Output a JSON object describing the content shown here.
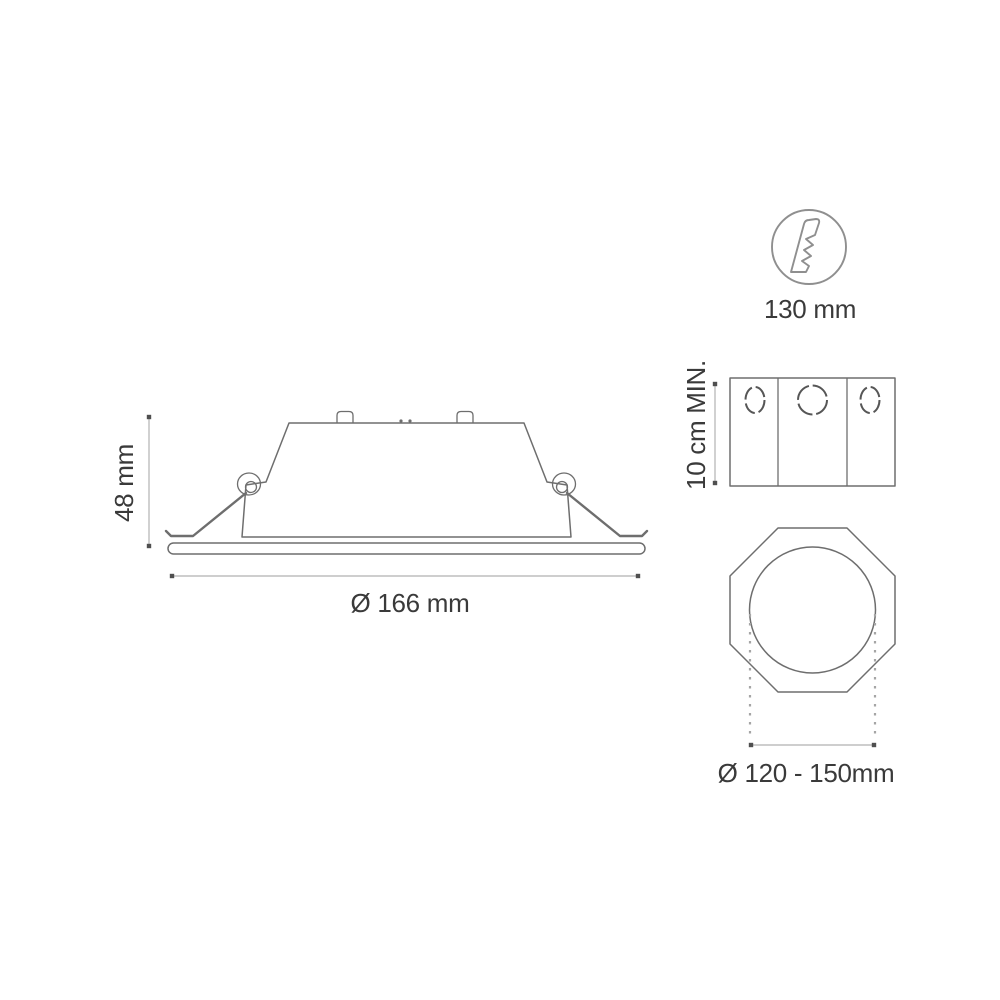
{
  "diagram": {
    "description": "Recessed LED downlight installation dimensional drawing",
    "side_view": {
      "height_dim": "48 mm",
      "diameter_dim": "Ø 166 mm"
    },
    "drill_icon": {
      "icon": "hole-saw-drill-bit",
      "label": "130 mm"
    },
    "junction_box": {
      "clearance_dim": "10 cm MIN."
    },
    "ceiling_cutout": {
      "cutout_dim": "Ø 120 - 150mm"
    }
  },
  "colors": {
    "line": "#6e6e6e",
    "line_soft": "#8f8f8f",
    "dim_line": "#bdbdbd",
    "dim_dot": "#4f4f4f",
    "knockout": "#565656",
    "drop_dash": "#a5a5a5",
    "text": "#3a3a3a",
    "bg": "#ffffff"
  }
}
